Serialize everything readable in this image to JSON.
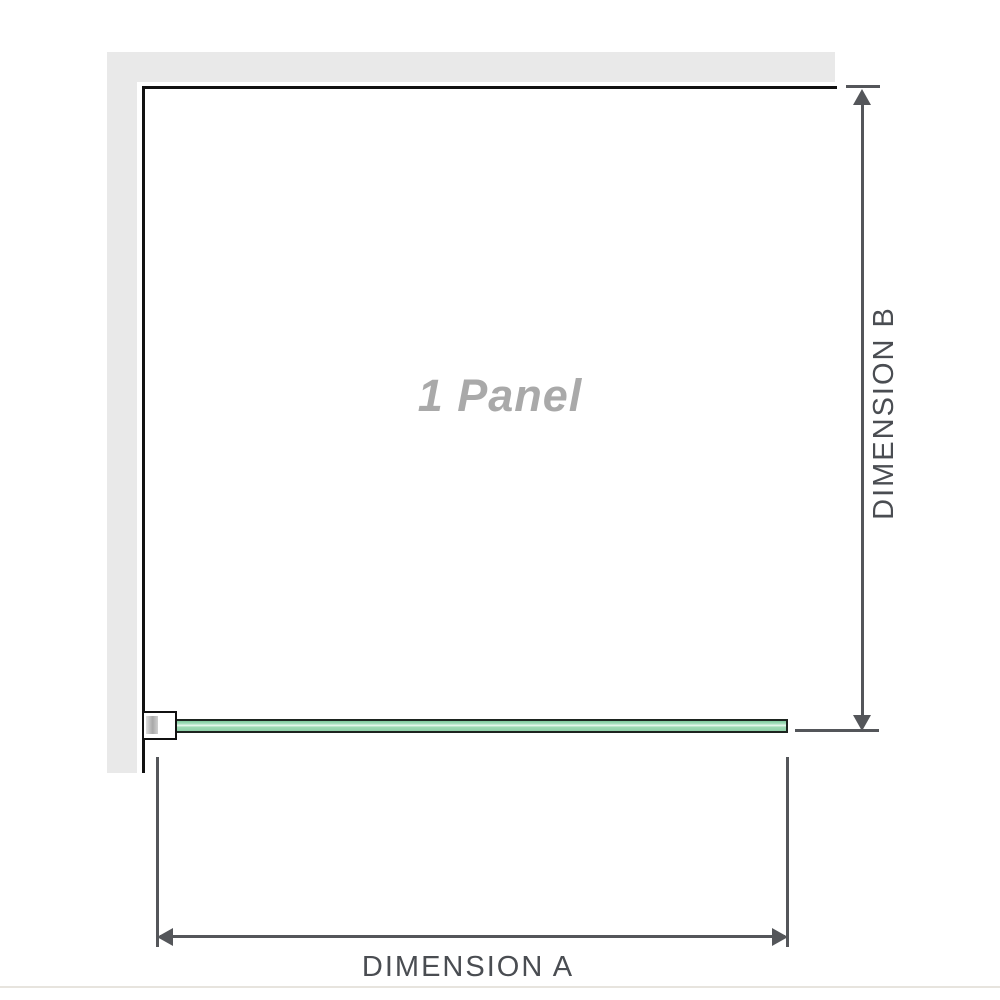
{
  "diagram": {
    "panel_label": "1 Panel",
    "dimension_a_label": "DIMENSION A",
    "dimension_b_label": "DIMENSION B"
  },
  "colors": {
    "wall": "#e9e9e9",
    "outline": "#111111",
    "dim": "#54565a",
    "panel_text": "#a9a9a9",
    "glass_border": "#1d241f",
    "glass_green": "#9fdab4",
    "glass_highlight": "#eefaf3",
    "baseline": "#e7e4de"
  }
}
